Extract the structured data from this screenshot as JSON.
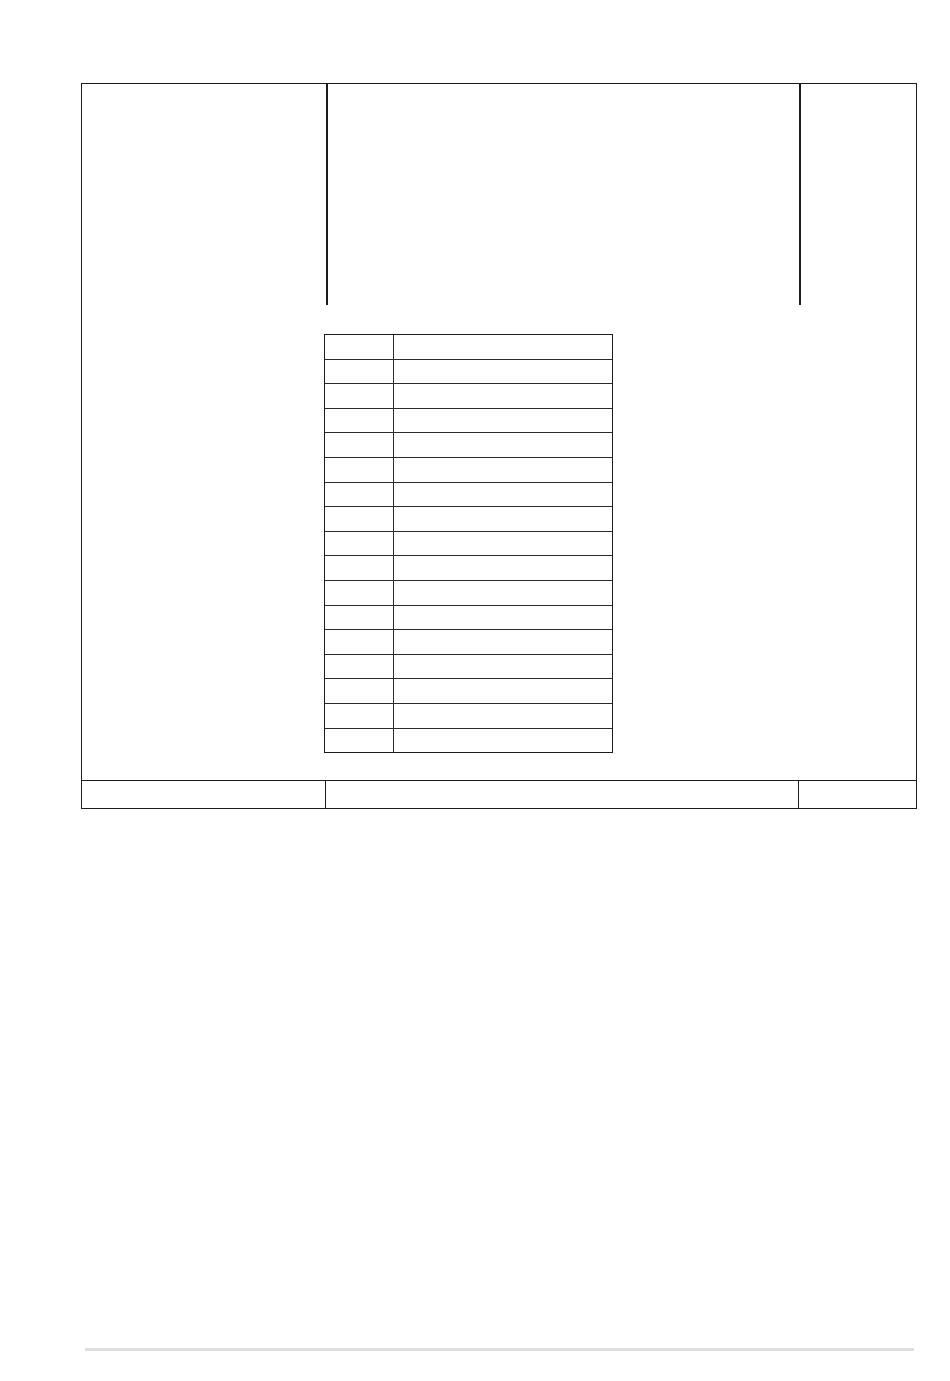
{
  "document": {
    "background_color": "#ffffff",
    "line_color": "#1c1c1c",
    "bottom_rule_color": "#dedede"
  },
  "title_block": {
    "header_left": "",
    "header_center": "",
    "header_right": "",
    "footer_left": "",
    "footer_center": "",
    "footer_right": ""
  },
  "parts_table": {
    "row_count": 17,
    "columns": [
      "",
      ""
    ],
    "rows": [
      [
        "",
        ""
      ],
      [
        "",
        ""
      ],
      [
        "",
        ""
      ],
      [
        "",
        ""
      ],
      [
        "",
        ""
      ],
      [
        "",
        ""
      ],
      [
        "",
        ""
      ],
      [
        "",
        ""
      ],
      [
        "",
        ""
      ],
      [
        "",
        ""
      ],
      [
        "",
        ""
      ],
      [
        "",
        ""
      ],
      [
        "",
        ""
      ],
      [
        "",
        ""
      ],
      [
        "",
        ""
      ],
      [
        "",
        ""
      ],
      [
        "",
        ""
      ]
    ]
  }
}
